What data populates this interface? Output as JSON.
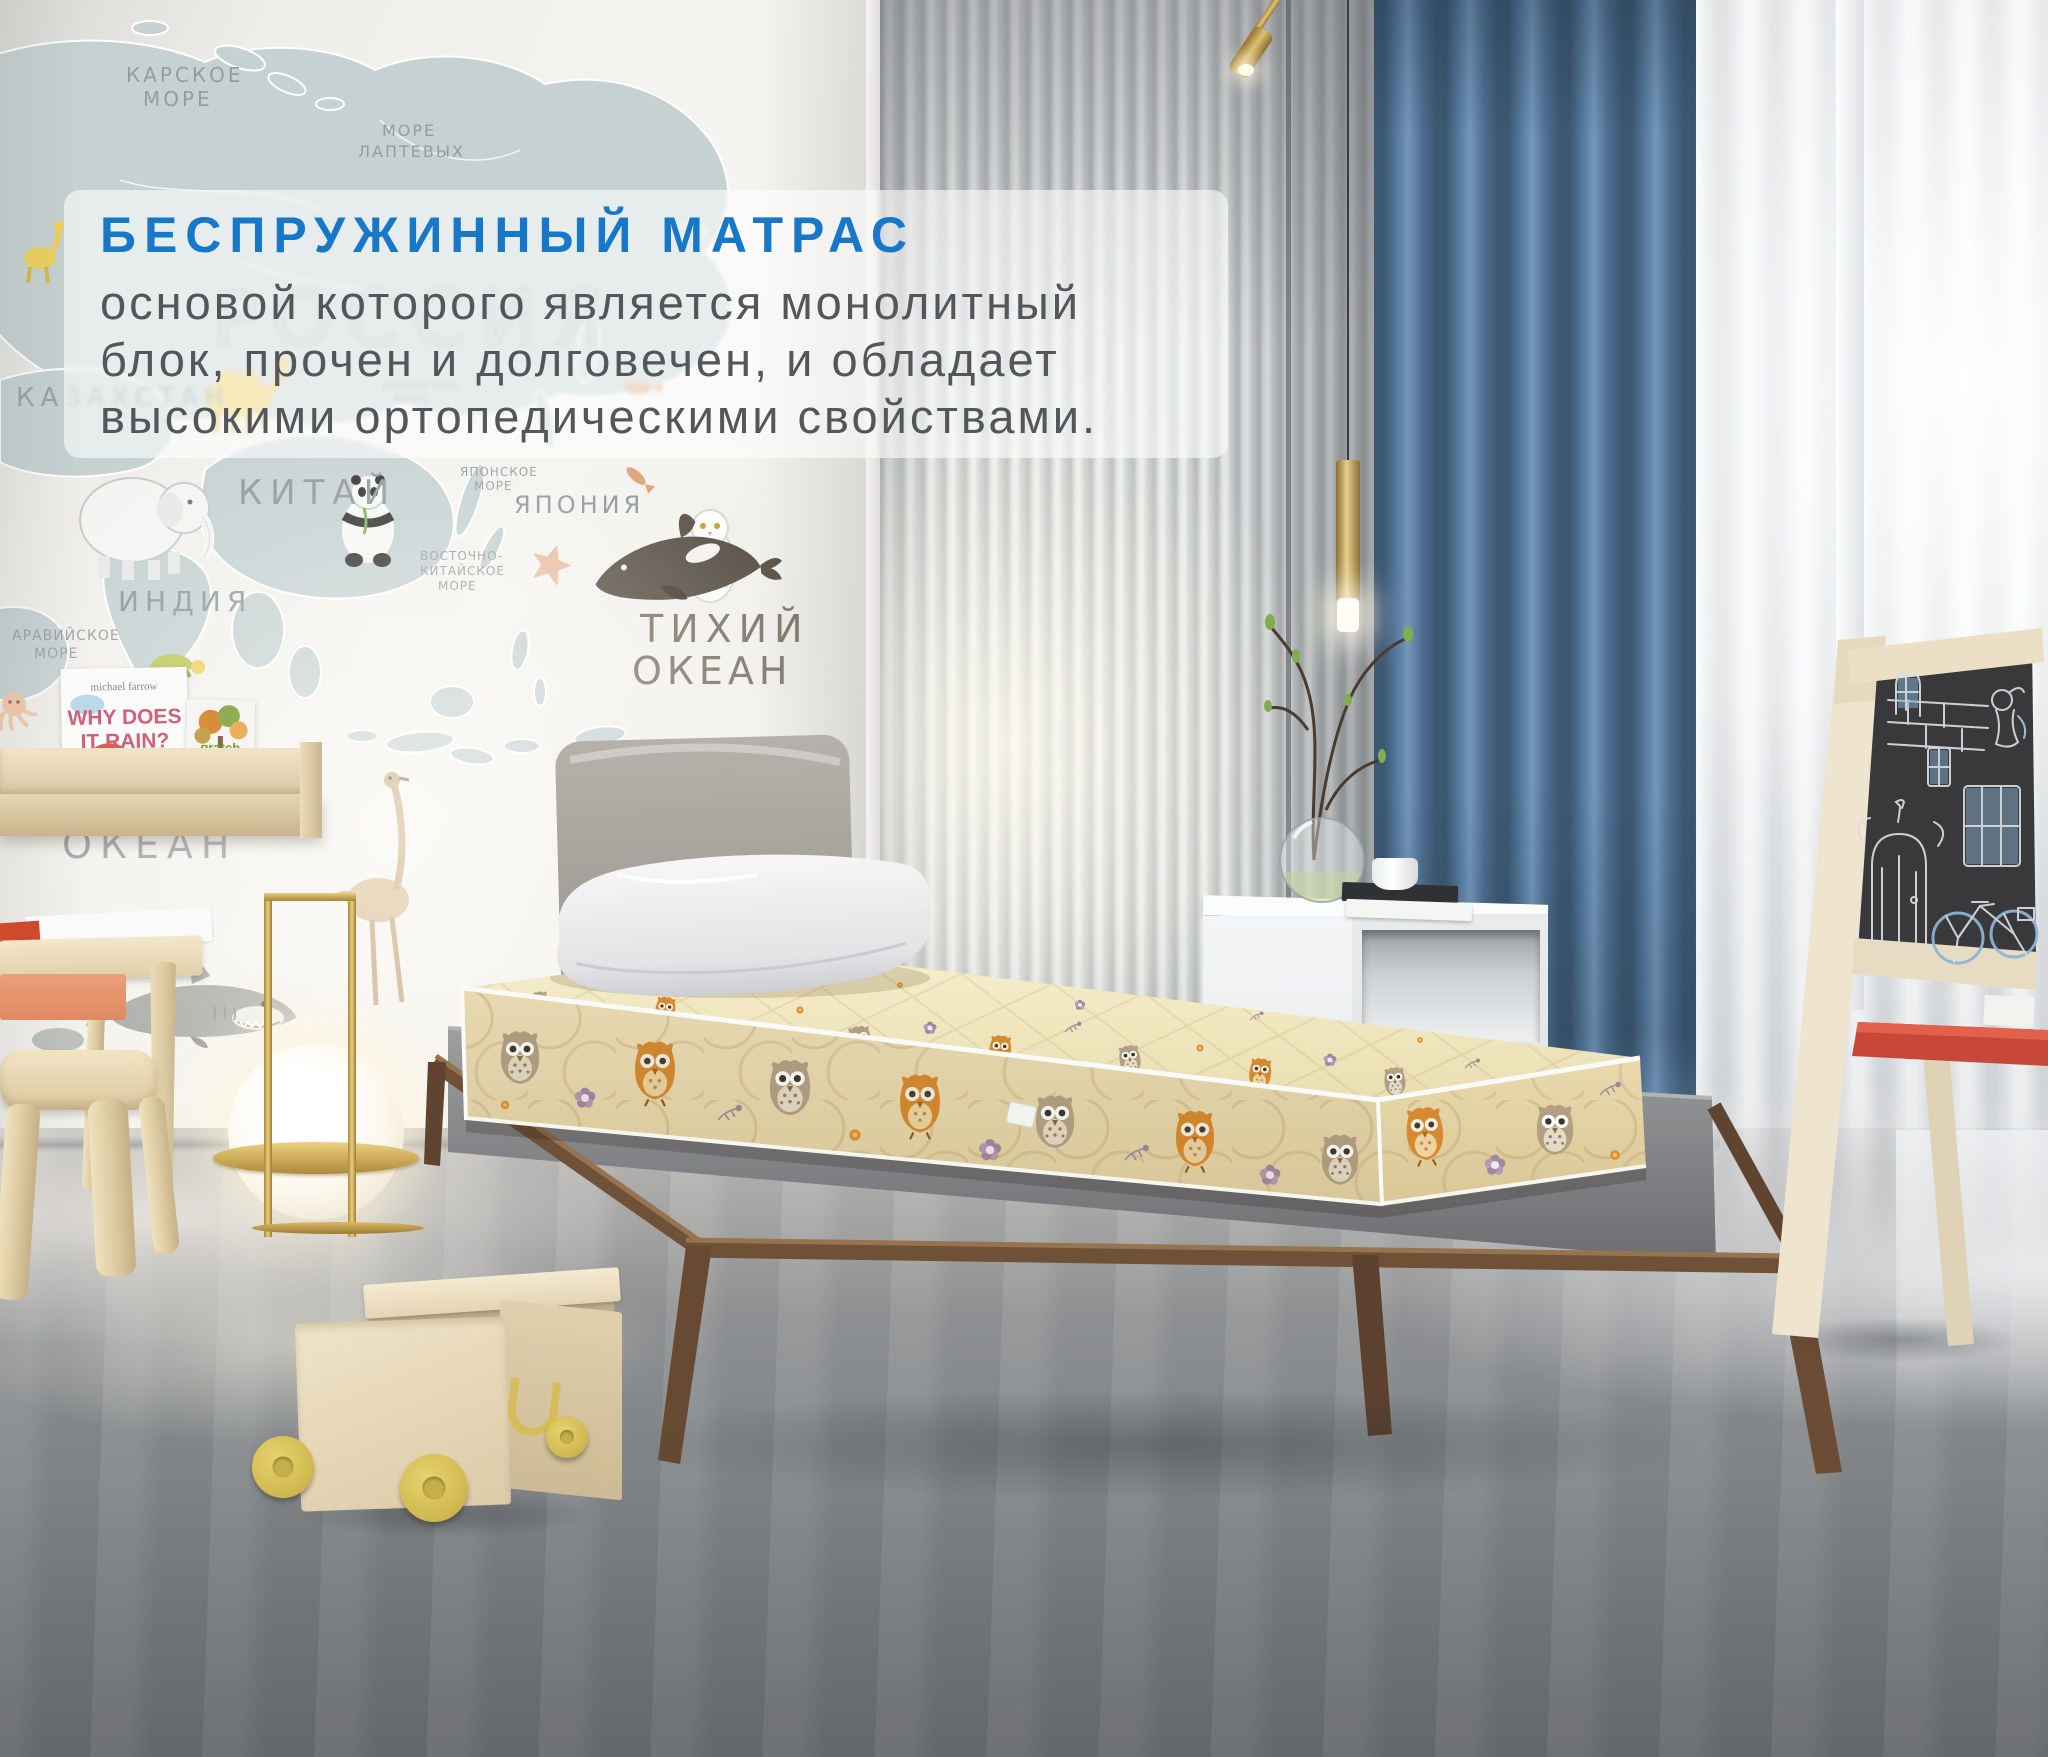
{
  "overlay": {
    "title": "БЕСПРУЖИННЫЙ МАТРАС",
    "title_color": "#1777c8",
    "body_line1": "основой которого является монолитный",
    "body_line2": "блок, прочен и долговечен, и обладает",
    "body_line3": "высокими ортопедическими свойствами."
  },
  "map_wall": {
    "country_labels": {
      "russia": "РОССИЯ",
      "kazakhstan": "КАЗАХСТАН",
      "china": "КИТАЙ",
      "india": "ИНДИЯ",
      "japan": "ЯПОНИЯ"
    },
    "sea_labels": {
      "kara_1": "КАРСКОЕ",
      "kara_2": "МОРЕ",
      "laptev_1": "МОРЕ",
      "laptev_2": "ЛАПТЕВЫХ",
      "bering_1": "БЕРИНГОВО",
      "bering_2": "МОРЕ",
      "japan_sea_1": "ЯПОНСКОЕ",
      "japan_sea_2": "МОРЕ",
      "east_china_1": "ВОСТОЧНО-",
      "east_china_2": "КИТАЙСКОЕ",
      "east_china_3": "МОРЕ",
      "arabian_1": "АРАВИЙСКОЕ",
      "arabian_2": "МОРЕ",
      "pacific_1": "ТИХИЙ",
      "pacific_2": "ОКЕАН",
      "indian_1": "ИНДИЙСКИЙ",
      "indian_2": "ОКЕАН"
    }
  },
  "shelf_books": {
    "book1_author": "michael farrow",
    "book1_title_1": "WHY DOES",
    "book1_title_2": "IT RAIN?",
    "book2_word": "gratch",
    "book2_sub": "butterfly"
  }
}
